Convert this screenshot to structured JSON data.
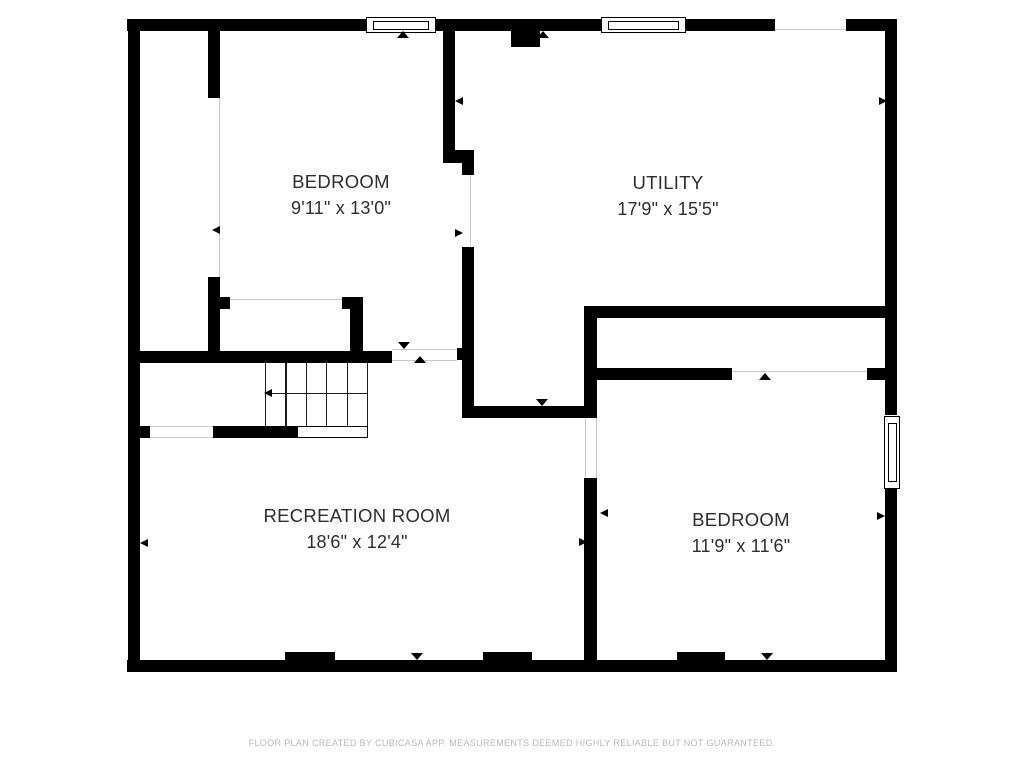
{
  "floor_plan": {
    "rooms": [
      {
        "name": "BEDROOM",
        "dimensions": "9'11\" x 13'0\""
      },
      {
        "name": "UTILITY",
        "dimensions": "17'9\" x 15'5\""
      },
      {
        "name": "RECREATION ROOM",
        "dimensions": "18'6\" x 12'4\""
      },
      {
        "name": "BEDROOM",
        "dimensions": "11'9\" x 11'6\""
      }
    ],
    "footer": "FLOOR PLAN CREATED BY CUBICASA APP. MEASUREMENTS DEEMED HIGHLY RELIABLE BUT NOT GUARANTEED.",
    "colors": {
      "wall": "#000000",
      "text": "#2e2e2e",
      "footer_text": "#b6b9bb",
      "opening_line": "#c9c9c9"
    }
  }
}
